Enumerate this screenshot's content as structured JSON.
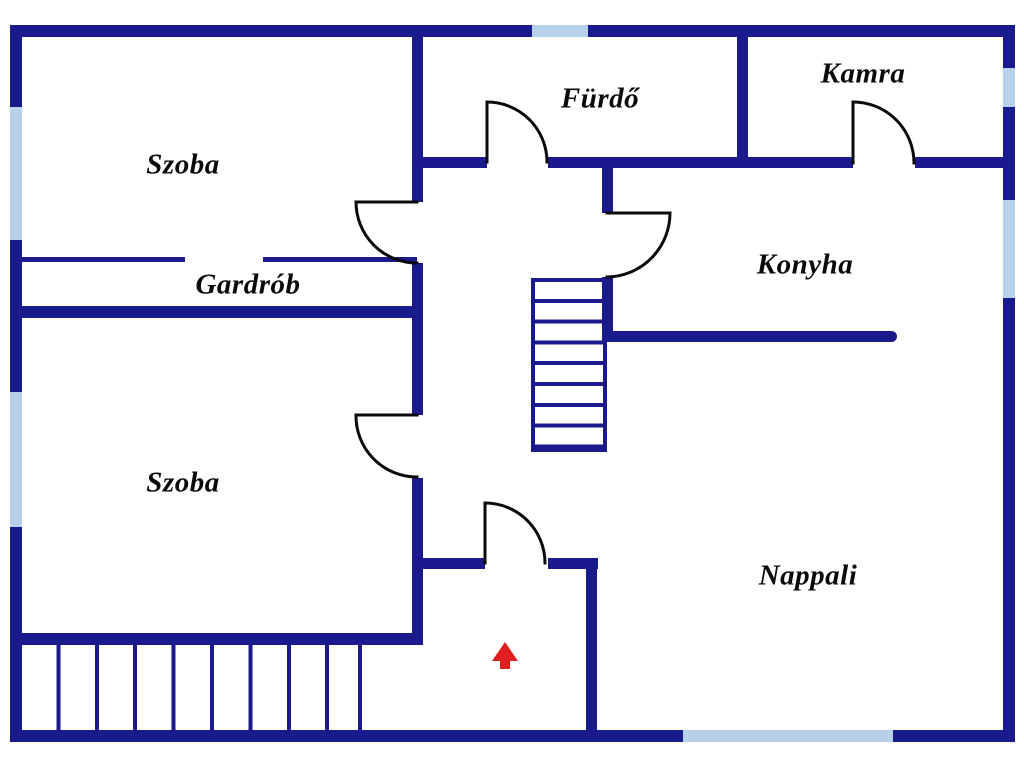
{
  "rooms": {
    "szoba_top": {
      "label": "Szoba"
    },
    "furdo": {
      "label": "Fürdő"
    },
    "kamra": {
      "label": "Kamra"
    },
    "gardrob": {
      "label": "Gardrób"
    },
    "konyha": {
      "label": "Konyha"
    },
    "szoba_bottom": {
      "label": "Szoba"
    },
    "nappali": {
      "label": "Nappali"
    }
  },
  "icons": {
    "entrance_arrow": "red-arrow-up-entrance-marker"
  },
  "colors": {
    "wall": "#1a1a8c",
    "window": "#b7d1ec",
    "door": "#0a0a0a",
    "text": "#0a0a0a",
    "arrow": "#e02020",
    "background": "#ffffff"
  }
}
